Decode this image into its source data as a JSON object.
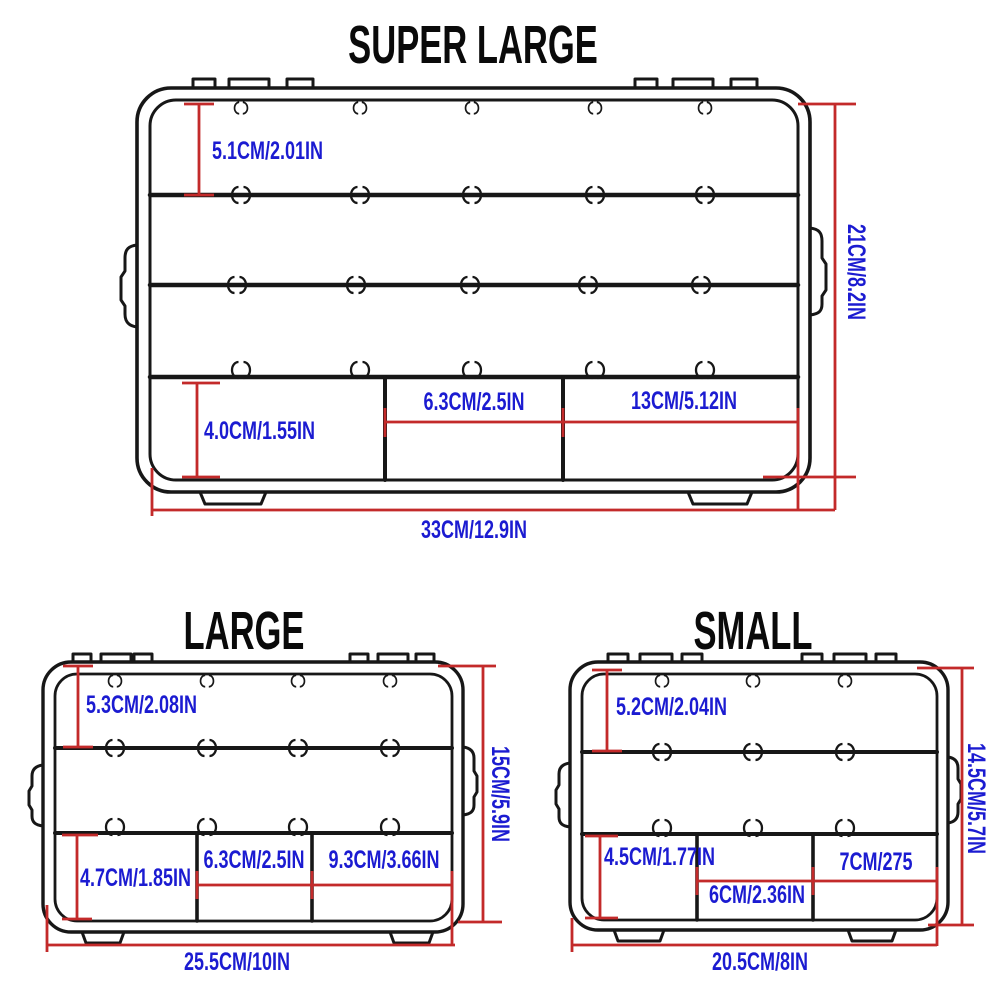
{
  "colors": {
    "label_blue": "#1b1bd1",
    "dimension_red": "#c32a2a",
    "line_black": "#171717",
    "background": "#ffffff"
  },
  "sections": {
    "super_large": {
      "title": "SUPER LARGE",
      "dims": {
        "top_row_height": "5.1CM/2.01IN",
        "total_height": "21CM/8.2IN",
        "bottom_row_height": "4.0CM/1.55IN",
        "bottom_mid_width": "6.3CM/2.5IN",
        "bottom_right_width": "13CM/5.12IN",
        "total_width": "33CM/12.9IN"
      }
    },
    "large": {
      "title": "LARGE",
      "dims": {
        "top_row_height": "5.3CM/2.08IN",
        "total_height": "15CM/5.9IN",
        "bottom_row_height": "4.7CM/1.85IN",
        "bottom_mid_width": "6.3CM/2.5IN",
        "bottom_right_width": "9.3CM/3.66IN",
        "total_width": "25.5CM/10IN"
      }
    },
    "small": {
      "title": "SMALL",
      "dims": {
        "top_row_height": "5.2CM/2.04IN",
        "total_height": "14.5CM/5.7IN",
        "bottom_row_height": "4.5CM/1.77IN",
        "bottom_mid_width": "6CM/2.36IN",
        "bottom_right_width": "7CM/275",
        "total_width": "20.5CM/8IN"
      }
    }
  }
}
